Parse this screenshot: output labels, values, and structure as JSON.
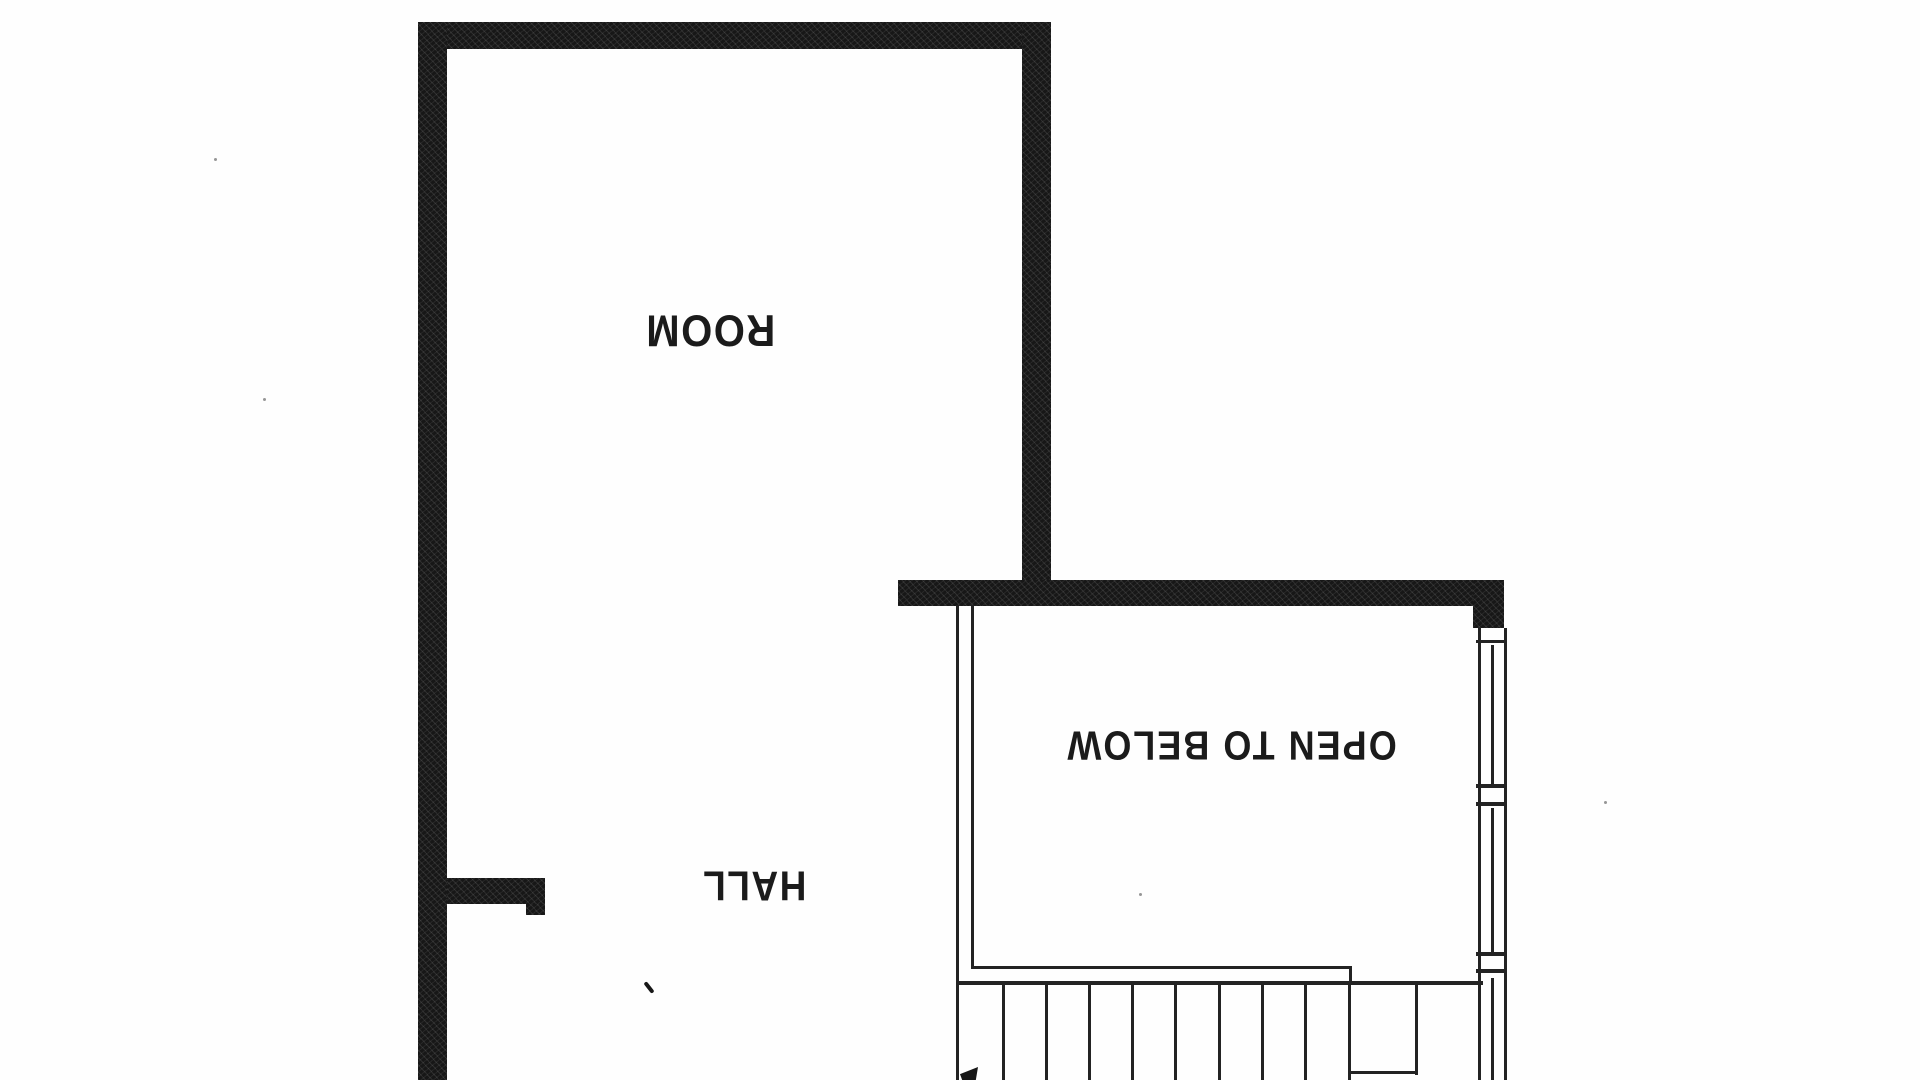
{
  "canvas": {
    "paper_color": "#fefefe",
    "ink_color": "#171717"
  },
  "floor_plan": {
    "text_orientation": "rotated-180",
    "labels": {
      "room": "ROOM",
      "hall": "HALL",
      "open_to_below": "OPEN TO BELOW"
    },
    "stairs": {
      "visible_riser_count": 10
    }
  }
}
